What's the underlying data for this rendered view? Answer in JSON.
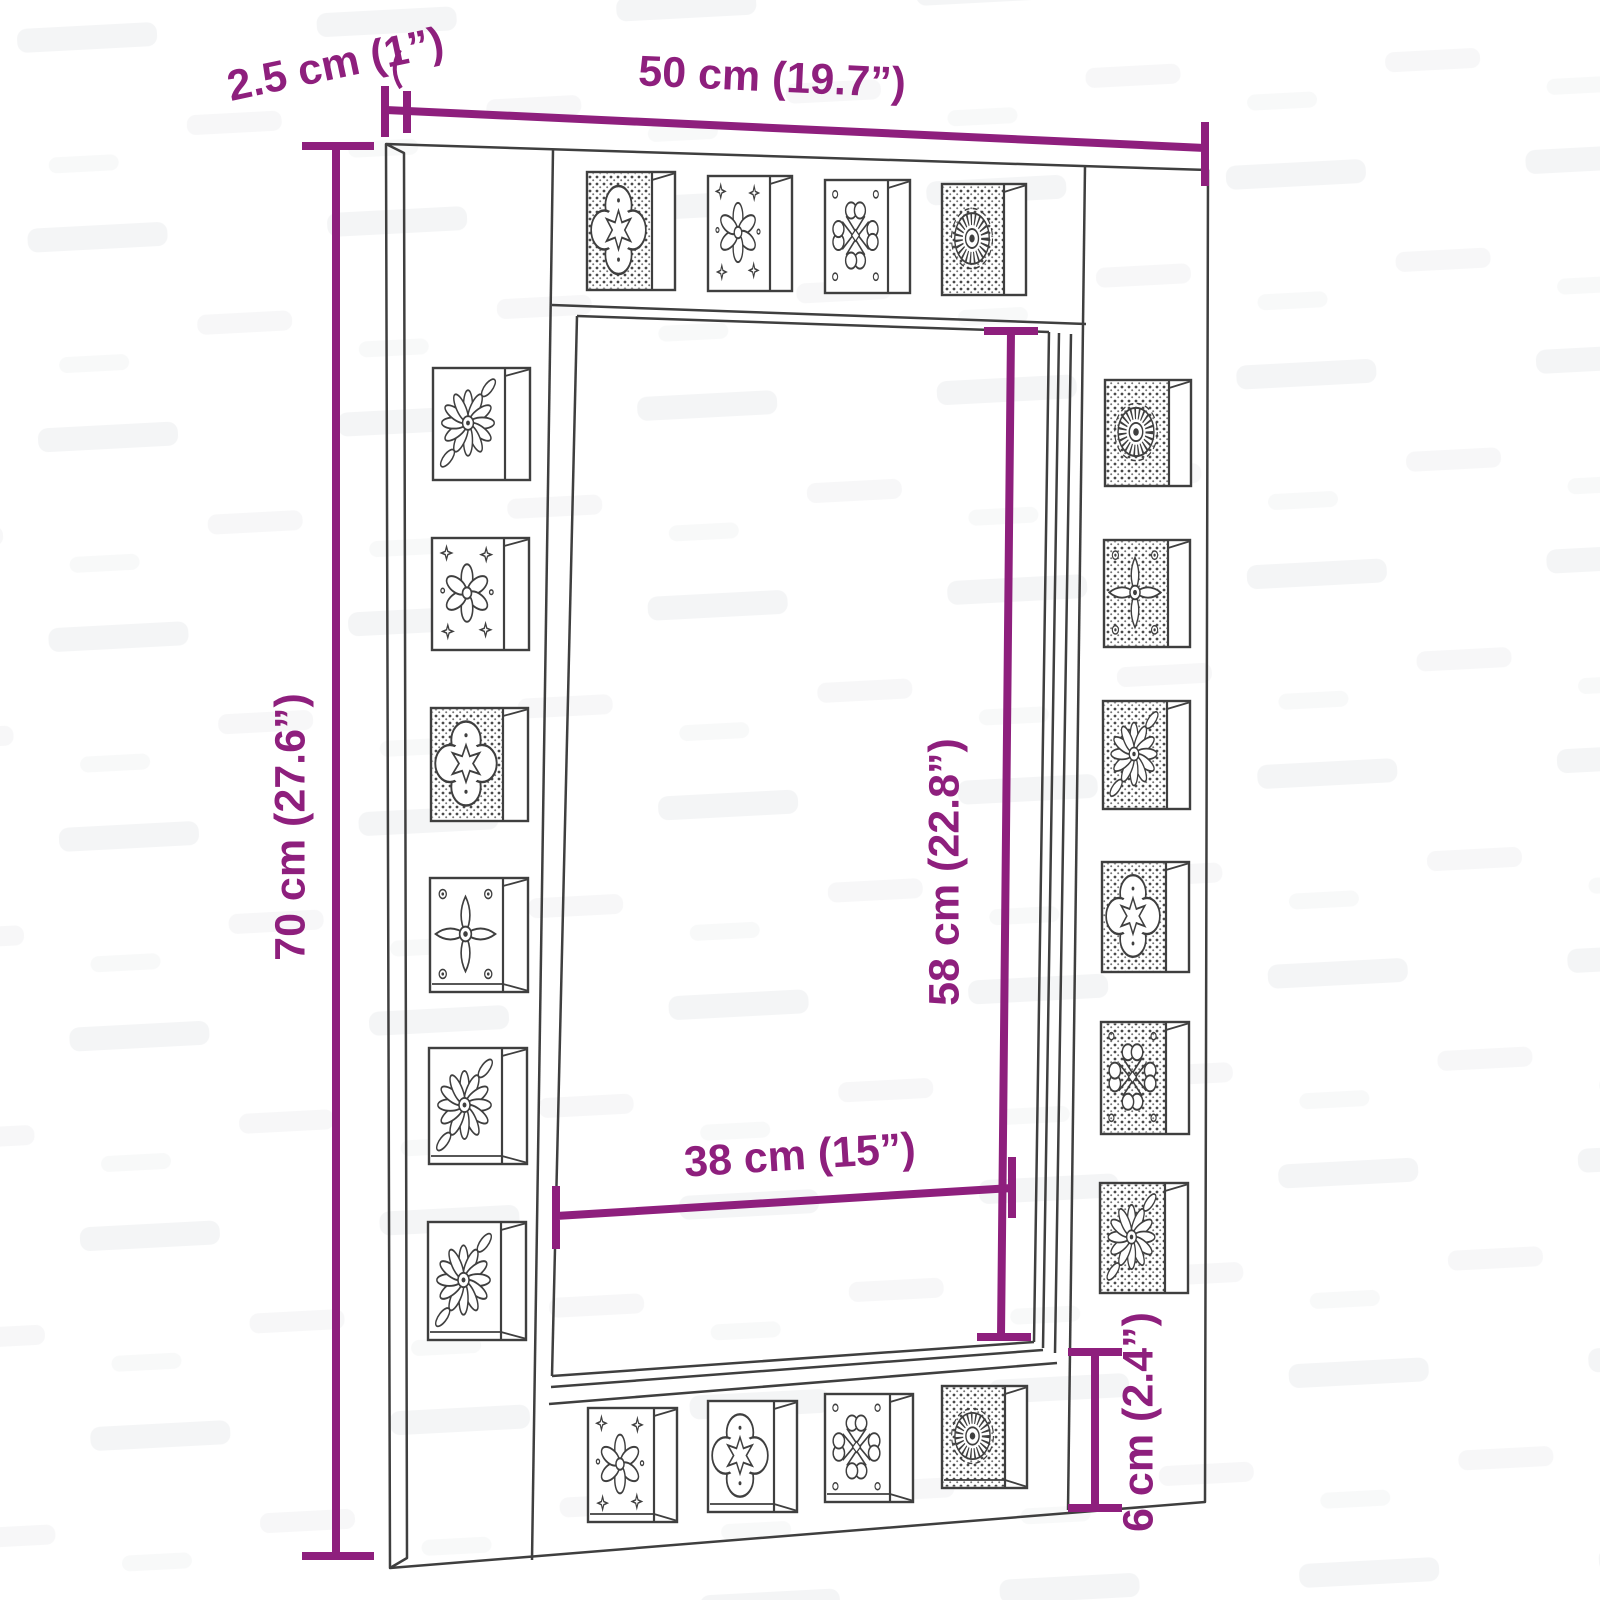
{
  "image": {
    "description": "Dimension diagram of a rectangular wall mirror with a border of decorative carved tiles",
    "background_color": "#ffffff",
    "accent_color": "#8e1f7d",
    "line_color": "#3f3f3f",
    "tiles_per_side": {
      "top": 4,
      "left": 6,
      "right": 6,
      "bottom": 4
    }
  },
  "dimensions": {
    "overall_width": "50 cm (19.7”)",
    "frame_depth": "2.5 cm (1”)",
    "overall_height": "70 cm (27.6”)",
    "mirror_height": "58 cm (22.8”)",
    "mirror_width": "38 cm (15”)",
    "bottom_border_height": "6 cm (2.4”)"
  }
}
